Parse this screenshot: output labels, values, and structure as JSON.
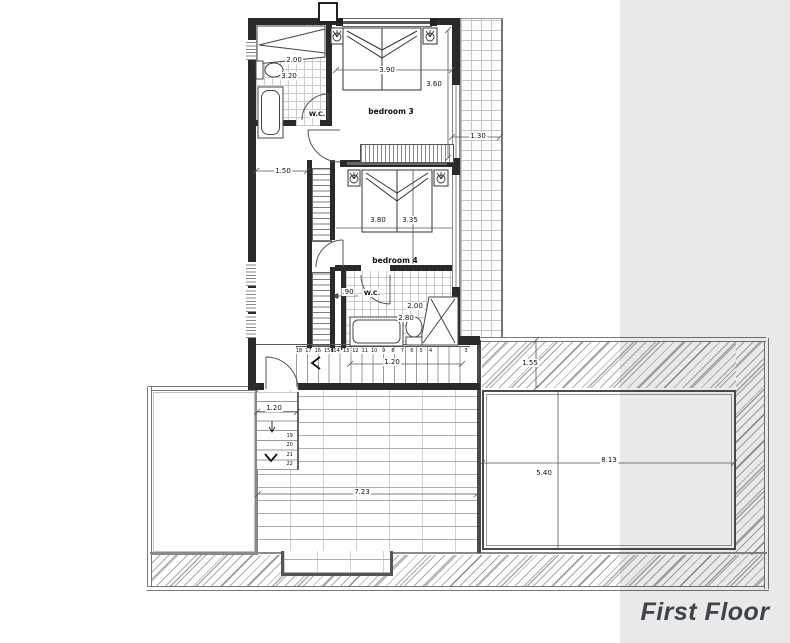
{
  "panel": {
    "floor_label": "First Floor",
    "bg_color": "#e8e8e8",
    "text_color": "#3d434b"
  },
  "rooms": {
    "bedroom3": {
      "label": "bedroom 3",
      "width": "3.90",
      "depth": "3.60"
    },
    "bedroom4": {
      "label": "bedroom 4",
      "width": "3.80",
      "depth": "3.35"
    },
    "wc1": {
      "label": "W.C.",
      "width": "2.00",
      "depth": "3.20"
    },
    "wc2": {
      "label": "W.C.",
      "dim_a": "2.00",
      "dim_b": "2.80"
    }
  },
  "dimensions": {
    "balcony_strip": "1.30",
    "landing": "1.50",
    "stair_flight_width": ".90",
    "corridor": "1.20",
    "roof_band": "1.55",
    "terrace_stair": "1.20",
    "terrace_width": "7.23",
    "pool_depth": "5.40",
    "pool_width": "8.13"
  },
  "stairs": {
    "corridor_steps": [
      "18",
      "17",
      "16",
      "15",
      "14",
      "13",
      "12",
      "11",
      "10",
      "9",
      "8",
      "7",
      "6",
      "5",
      "4",
      "3"
    ],
    "terrace_steps": [
      "19",
      "20",
      "21",
      "22"
    ]
  }
}
